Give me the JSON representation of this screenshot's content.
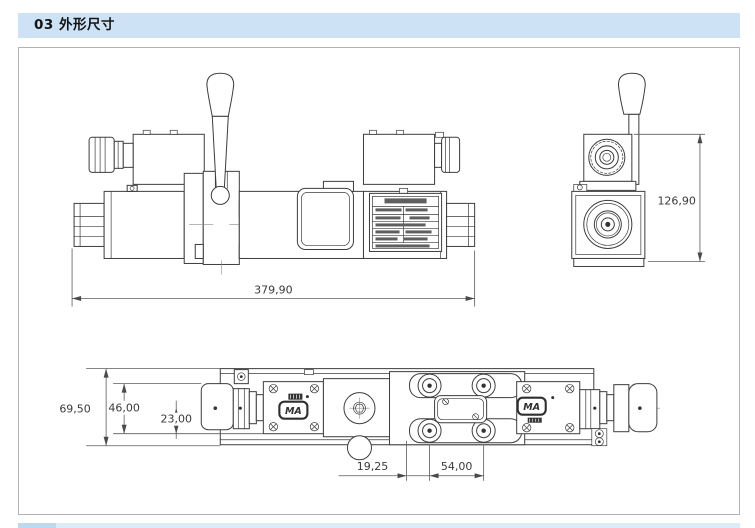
{
  "header": {
    "title": "03 外形尺寸"
  },
  "drawing": {
    "labels": {
      "ma_logo": "MA"
    },
    "dimensions": {
      "side_total_length": "379,90",
      "end_total_height": "126,90",
      "top_plate_width": "69,50",
      "top_coil_width": "46,00",
      "top_center_to_edge": "23,00",
      "mount_hole_offset": "19,25",
      "mount_hole_spacing": "54,00"
    }
  }
}
